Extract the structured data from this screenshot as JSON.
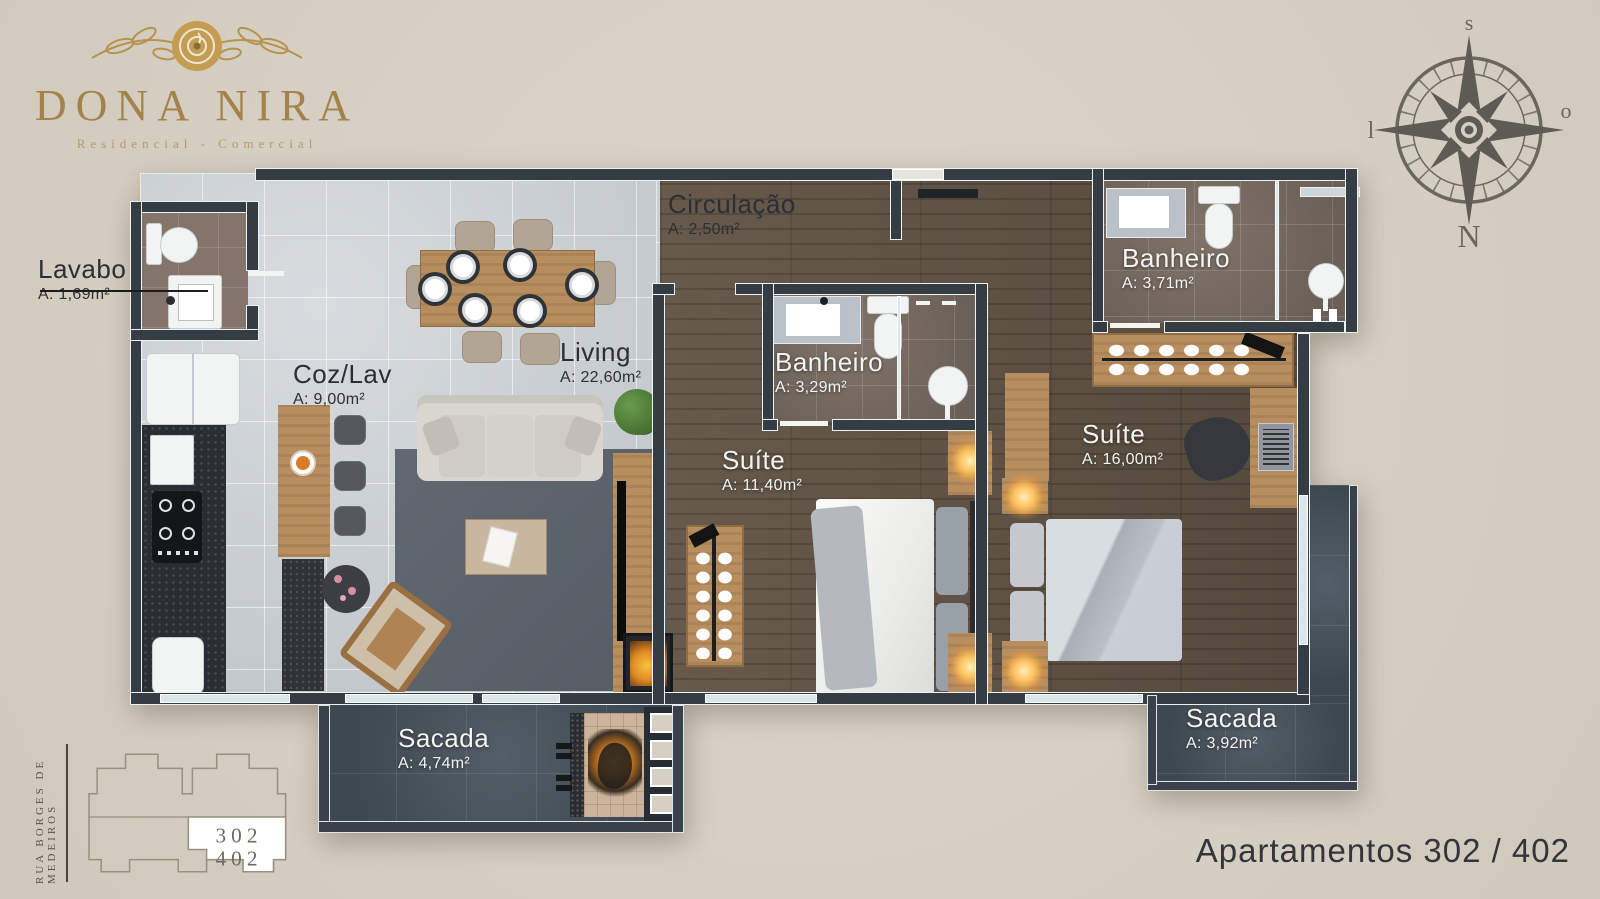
{
  "logo": {
    "title": "DONA NIRA",
    "subtitle": "Residencial - Comercial"
  },
  "compass": {
    "top": "s",
    "right": "o",
    "bottom": "N",
    "left": "l"
  },
  "rooms": [
    {
      "name": "Lavabo",
      "area": "A: 1,69m²"
    },
    {
      "name": "Circulação",
      "area": "A: 2,50m²"
    },
    {
      "name": "Coz/Lav",
      "area": "A: 9,00m²"
    },
    {
      "name": "Living",
      "area": "A: 22,60m²"
    },
    {
      "name": "Banheiro",
      "area": "A: 3,29m²"
    },
    {
      "name": "Banheiro",
      "area": "A: 3,71m²"
    },
    {
      "name": "Suíte",
      "area": "A: 11,40m²"
    },
    {
      "name": "Suíte",
      "area": "A: 16,00m²"
    },
    {
      "name": "Sacada",
      "area": "A: 4,74m²"
    },
    {
      "name": "Sacada",
      "area": "A: 3,92m²"
    }
  ],
  "key_plan": {
    "street": "RUA BORGES DE MEDEIROS",
    "units": [
      "302",
      "402"
    ]
  },
  "footer": {
    "title": "Apartamentos 302 / 402"
  },
  "colors": {
    "background": "#d6cfc3",
    "gold": "#a8894c",
    "wall": "#343d44",
    "light_floor": "#c9cdd1",
    "wood_floor": "#5c5043",
    "bath_floor": "#76695f",
    "balcony_floor": "#49535d",
    "lamp_glow": "#ffb84d"
  }
}
